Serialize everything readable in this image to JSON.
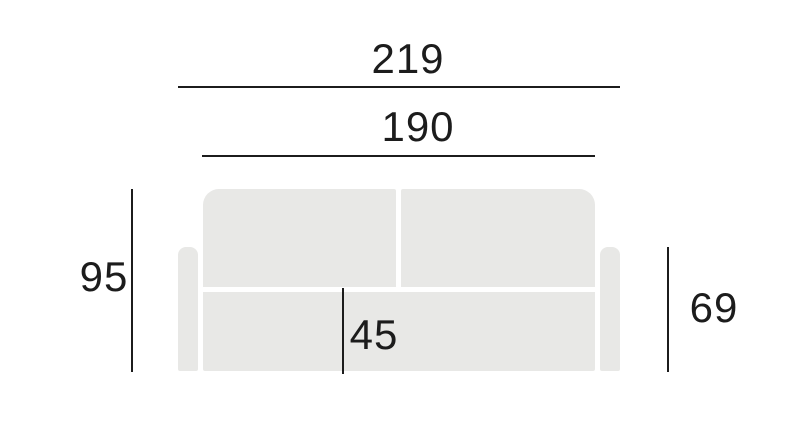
{
  "figure": {
    "name": "sofa front elevation dimension drawing",
    "background_color": "#ffffff",
    "line_color": "#1c1c1c",
    "sofa_fill_color": "#e8e8e6"
  },
  "dimensions": {
    "overall_width": {
      "value": "219",
      "orientation": "horizontal"
    },
    "seat_width": {
      "value": "190",
      "orientation": "horizontal"
    },
    "overall_height": {
      "value": "95",
      "orientation": "vertical"
    },
    "armrest_height": {
      "value": "69",
      "orientation": "vertical"
    },
    "seat_height": {
      "value": "45",
      "orientation": "vertical"
    }
  }
}
